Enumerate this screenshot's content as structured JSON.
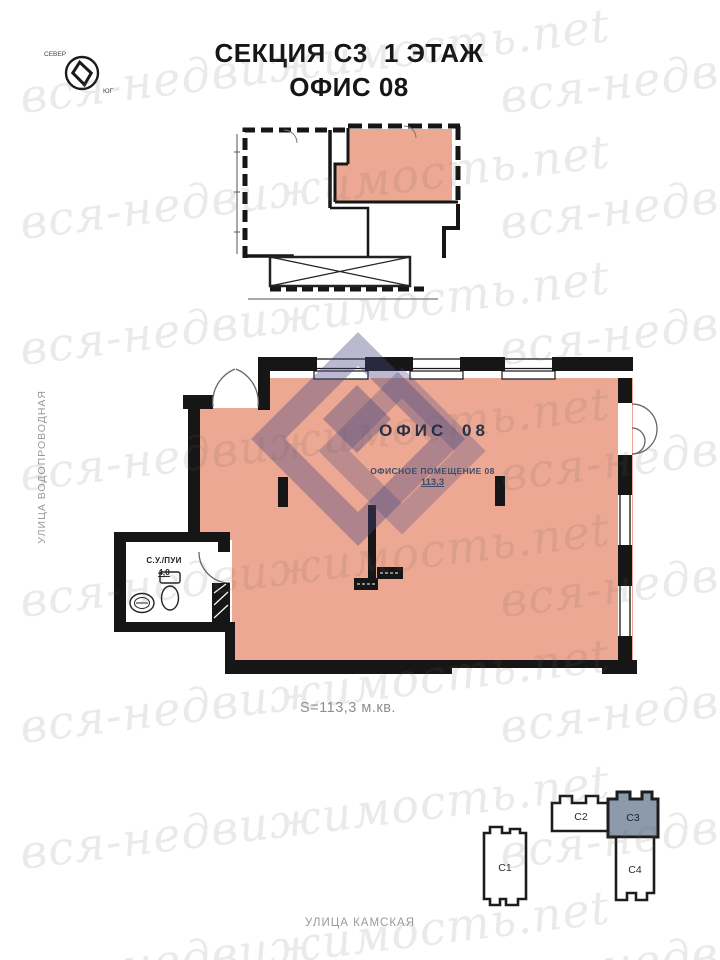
{
  "header": {
    "title_section": "СЕКЦИЯ С3",
    "title_floor": "1 ЭТАЖ",
    "title_office": "ОФИС 08"
  },
  "compass": {
    "north_label": "СЕВЕР",
    "south_label": "ЮГ"
  },
  "main_plan": {
    "office_title": "ОФИС 08",
    "room_name": "ОФИСНОЕ ПОМЕЩЕНИЕ 08",
    "room_area": "113,3",
    "wc_name": "С.У./ПУИ",
    "wc_area": "4,0",
    "total_area": "S=113,3 м.кв."
  },
  "streets": {
    "left_street": "УЛИЦА ВОДОПРОВОДНАЯ",
    "bottom_street": "УЛИЦА КАМСКАЯ"
  },
  "section_map": {
    "sections": [
      {
        "label": "С1",
        "highlighted": false
      },
      {
        "label": "С2",
        "highlighted": false
      },
      {
        "label": "С3",
        "highlighted": true
      },
      {
        "label": "С4",
        "highlighted": false
      }
    ]
  },
  "watermark": {
    "text": "вся-недвижимость.net"
  },
  "colors": {
    "unit_highlight": "#ECA892",
    "section_highlight": "#8D9AAB",
    "plan_label_navy": "#262E45",
    "room_label_navy": "#3E4D68",
    "street_gray": "#9A9A9A",
    "logo_purple": "#4A4880"
  }
}
